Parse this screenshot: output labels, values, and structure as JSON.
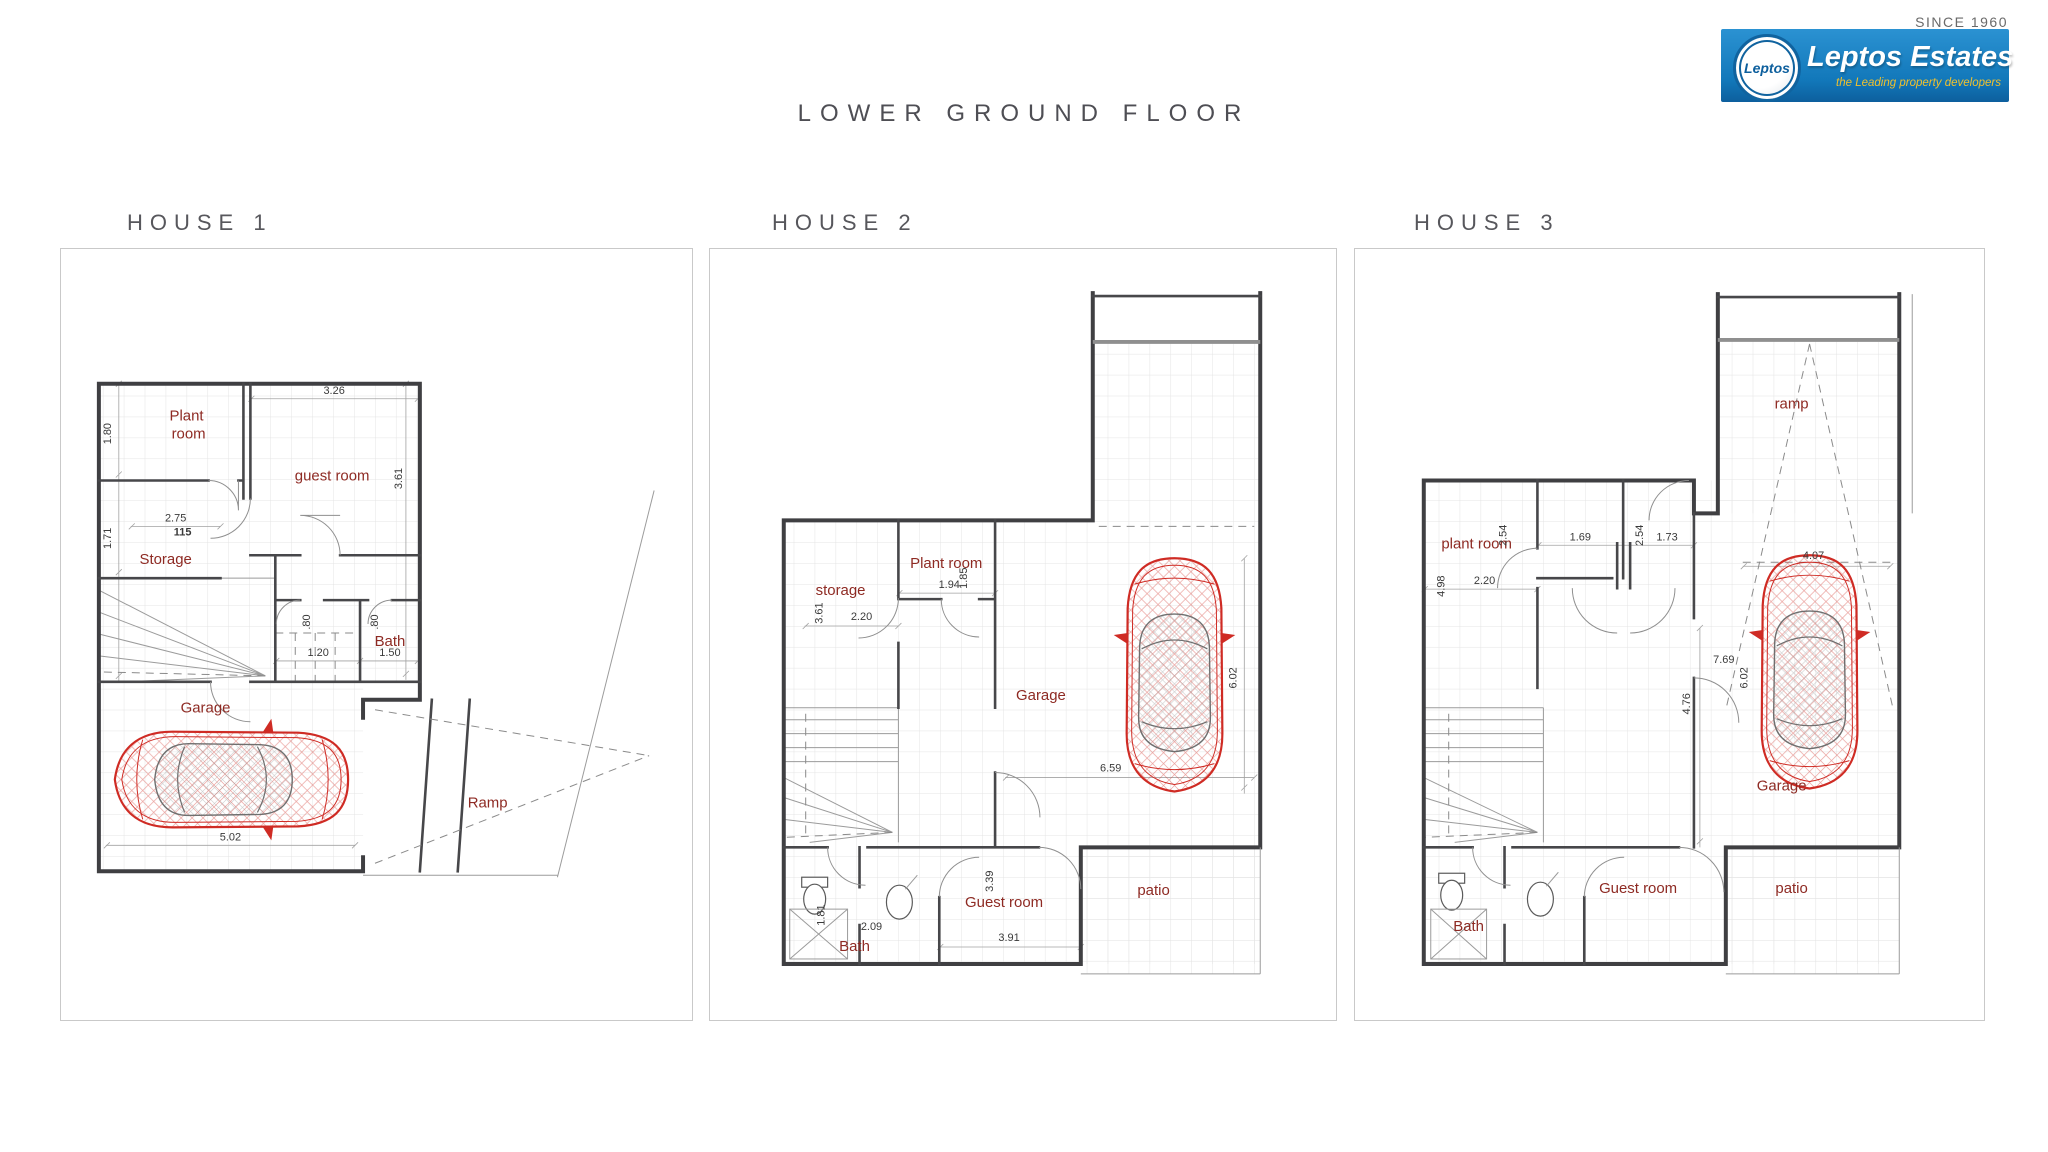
{
  "header": {
    "since": "SINCE 1960",
    "logo": {
      "badge": "Leptos",
      "name": "Leptos Estates",
      "tagline": "the Leading property developers"
    }
  },
  "title": "LOWER GROUND FLOOR",
  "colors": {
    "room_label": "#8e2a23",
    "wall": "#3f3f42",
    "car_outline": "#cf2b24",
    "heading_text": "#57575c",
    "logo_blue": "#1b7fc4",
    "logo_tagline_yellow": "#f0c02e"
  },
  "houses": [
    {
      "heading": "HOUSE 1",
      "rooms": {
        "plant_line1": "Plant",
        "plant_line2": "room",
        "guest": "guest room",
        "storage": "Storage",
        "bath": "Bath",
        "garage": "Garage",
        "ramp": "Ramp"
      },
      "dims": {
        "h180": "1.80",
        "w326": "3.26",
        "h361": "3.61",
        "h171": "1.71",
        "w275": "2.75",
        "lvl115": "115",
        "h080a": ".80",
        "h080b": ".80",
        "w120": "1.20",
        "w150": "1.50",
        "w502": "5.02"
      }
    },
    {
      "heading": "HOUSE 2",
      "rooms": {
        "storage": "storage",
        "plant": "Plant room",
        "garage": "Garage",
        "guest": "Guest room",
        "bath": "Bath",
        "patio": "patio"
      },
      "dims": {
        "h361": "3.61",
        "w220": "2.20",
        "w194": "1.94",
        "h185": "1.85",
        "h602": "6.02",
        "w659": "6.59",
        "h339": "3.39",
        "w391": "3.91",
        "w209": "2.09",
        "h181": "1.81"
      }
    },
    {
      "heading": "HOUSE 3",
      "rooms": {
        "plant": "plant room",
        "ramp": "ramp",
        "garage": "Garage",
        "guest": "Guest room",
        "bath": "Bath",
        "patio": "patio"
      },
      "dims": {
        "h254a": "2.54",
        "w169": "1.69",
        "h254b": "2.54",
        "w173": "1.73",
        "h498": "4.98",
        "w220": "2.20",
        "w407": "4.07",
        "w769": "7.69",
        "h602": "6.02",
        "h476": "4.76"
      }
    }
  ]
}
